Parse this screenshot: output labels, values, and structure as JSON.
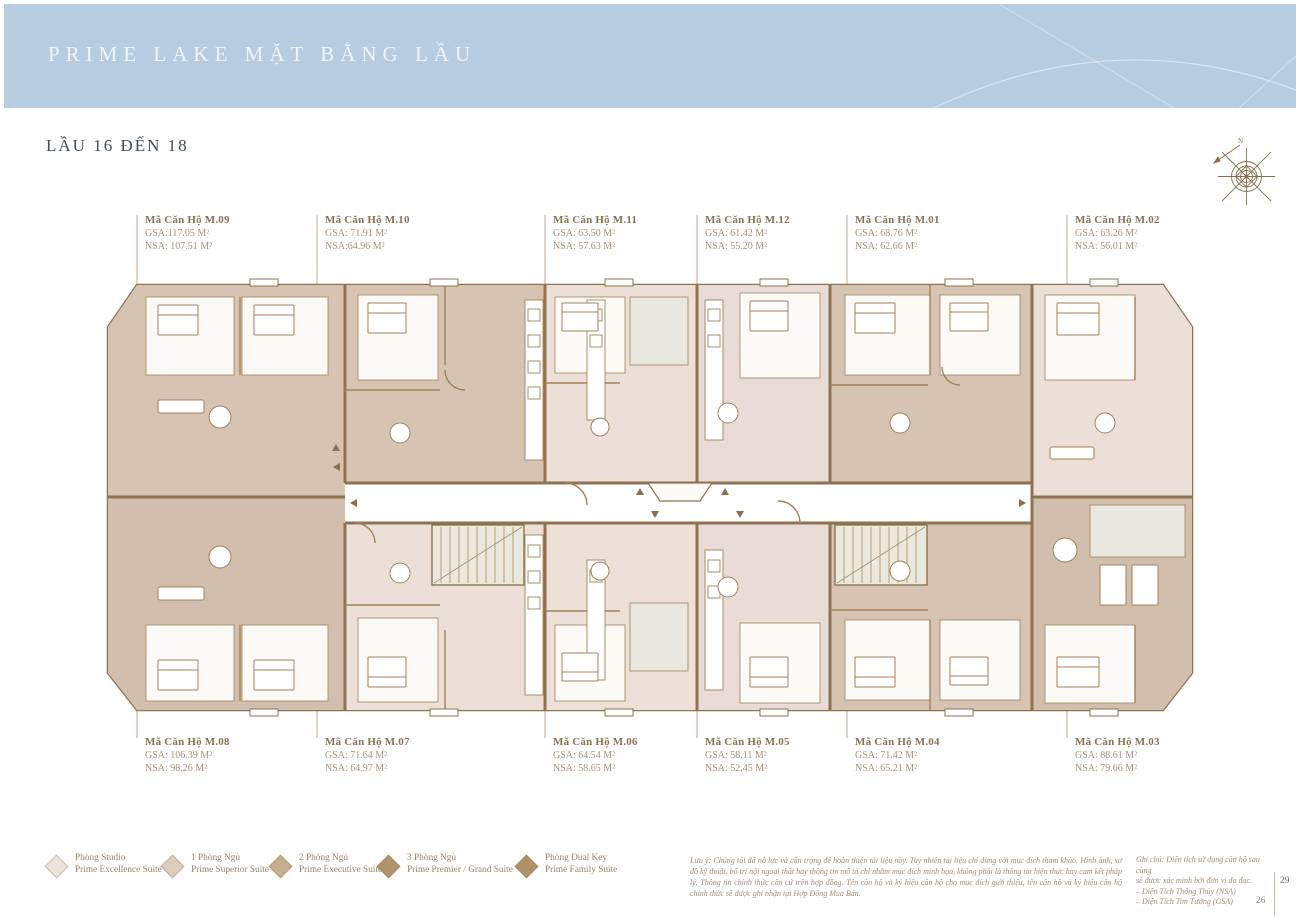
{
  "header": {
    "title": "PRIME LAKE MẶT BẰNG LẦU"
  },
  "subtitle": "LẦU 16 ĐẾN 18",
  "compass": {
    "label": "N"
  },
  "colors": {
    "header_bg": "#b5cce1",
    "wall_brown": "#8f7351",
    "unit_tan": "#d7c3b2",
    "unit_blush": "#ecdfd8",
    "core_grey": "#ebe9dd",
    "label_brown": "#8a7254"
  },
  "plan": {
    "units_top": [
      {
        "code": "Mã Căn Hộ M.09",
        "gsa": "GSA:117.05 M²",
        "nsa": "NSA: 107.51 M²"
      },
      {
        "code": "Mã Căn Hộ M.10",
        "gsa": "GSA: 71.91 M²",
        "nsa": "NSA:64.96 M²"
      },
      {
        "code": "Mã Căn Hộ M.11",
        "gsa": "GSA: 63.50 M²",
        "nsa": "NSA: 57.63 M²"
      },
      {
        "code": "Mã Căn Hộ M.12",
        "gsa": "GSA: 61.42 M²",
        "nsa": "NSA: 55.20 M²"
      },
      {
        "code": "Mã Căn Hộ M.01",
        "gsa": "GSA: 68.76 M²",
        "nsa": "NSA: 62.66 M²"
      },
      {
        "code": "Mã Căn Hộ M.02",
        "gsa": "GSA: 63.26 M²",
        "nsa": "NSA: 56.01 M²"
      }
    ],
    "units_bottom": [
      {
        "code": "Mã Căn Hộ M.08",
        "gsa": "GSA: 106.39 M²",
        "nsa": "NSA: 98.26 M²"
      },
      {
        "code": "Mã Căn Hộ M.07",
        "gsa": "GSA: 71.64 M²",
        "nsa": "NSA: 64.97 M²"
      },
      {
        "code": "Mã Căn Hộ M.06",
        "gsa": "GSA: 64.54 M²",
        "nsa": "NSA: 58.65 M²"
      },
      {
        "code": "Mã Căn Hộ M.05",
        "gsa": "GSA: 58.11 M²",
        "nsa": "NSA: 52.45 M²"
      },
      {
        "code": "Mã Căn Hộ M.04",
        "gsa": "GSA: 71.42 M²",
        "nsa": "NSA: 65.21 M²"
      },
      {
        "code": "Mã Căn Hộ M.03",
        "gsa": "GSA: 88.61 M²",
        "nsa": "NSA: 79.66 M²"
      }
    ]
  },
  "legend": [
    {
      "color": "#ece3da",
      "line1": "Phòng Studio",
      "line2": "Prime Excellence Suite"
    },
    {
      "color": "#dccdbd",
      "line1": "1 Phòng Ngủ",
      "line2": "Prime Superior Suite"
    },
    {
      "color": "#c6ae8e",
      "line1": "2 Phòng Ngủ",
      "line2": "Prime Executive Suite"
    },
    {
      "color": "#b1946b",
      "line1": "3 Phòng Ngủ",
      "line2": "Prime Premier / Grand Suite"
    },
    {
      "color": "#af9269",
      "line1": "Phòng Dual Key",
      "line2": "Prime Family Suite"
    }
  ],
  "disclaimer": "Lưu ý: Chúng tôi đã nỗ lực và cẩn trọng để hoàn thiện tài liệu này. Tuy nhiên tài liệu chỉ dùng với mục đích tham khảo. Hình ảnh, sơ đồ kỹ thuật, bố trí nội ngoại thất hay thông tin mô tả chỉ nhằm mục đích minh họa, không phải là thông tin hiện thực hay cam kết pháp lý. Thông tin chính thức căn cứ trên hợp đồng. Tên căn hộ và ký hiệu căn hộ cho mục đích giới thiệu, tên căn hộ và ký hiệu căn hộ chính thức sẽ được ghi nhận tại Hợp Đồng Mua Bán.",
  "note": {
    "lines": [
      "Ghi chú: Diện tích sử dụng căn hộ sau cùng",
      "sẽ được xác minh bởi đơn vị đo đạc.",
      "– Diện Tích Thông Thủy (NSA)",
      "– Diện Tích Tim Tường (GSA)"
    ]
  },
  "page_numbers": {
    "current": "29",
    "secondary": "26"
  }
}
